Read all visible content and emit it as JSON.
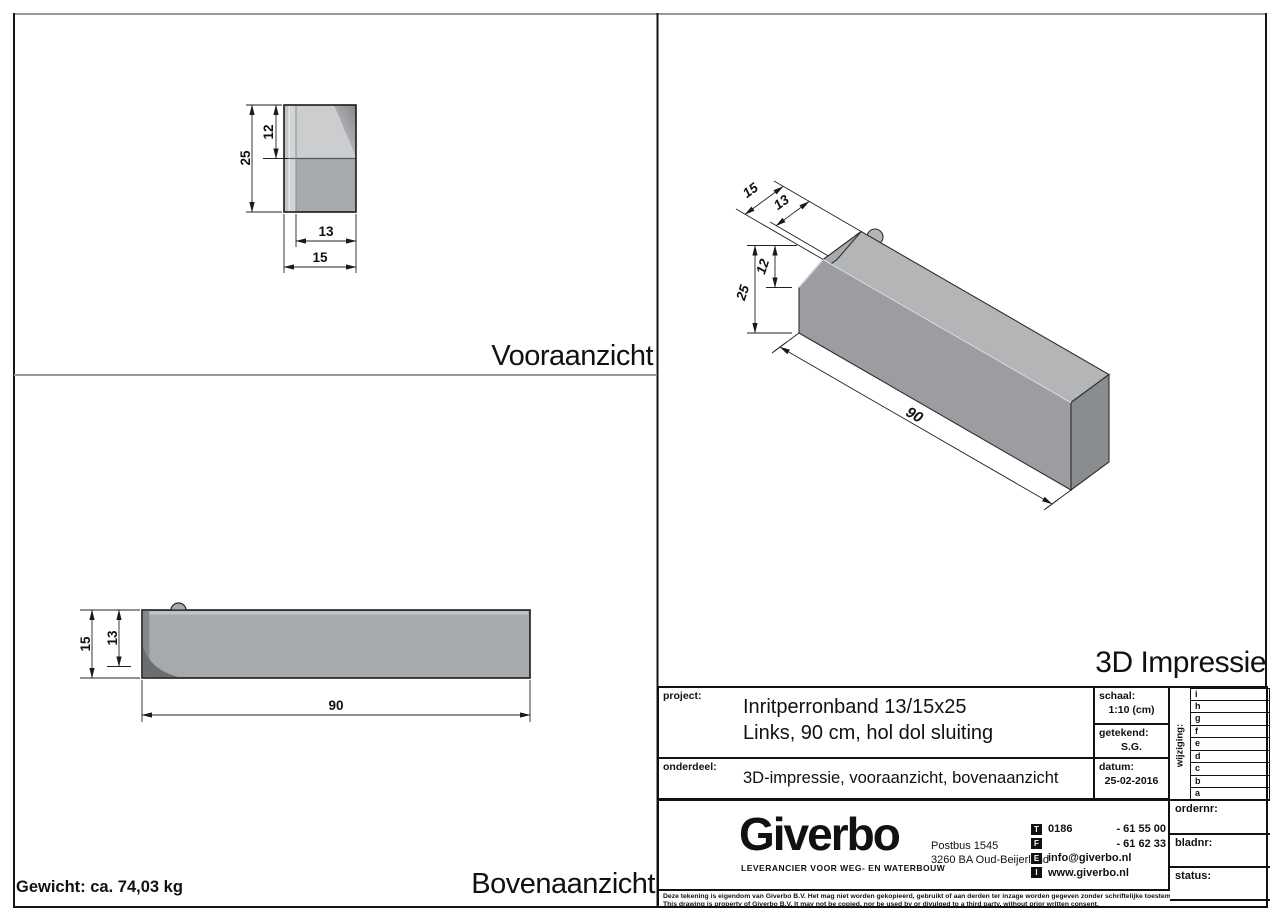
{
  "views": {
    "front": {
      "label": "Vooraanzicht",
      "dims": {
        "total_height": "25",
        "top_height": "12",
        "inner_width": "13",
        "total_width": "15"
      }
    },
    "top": {
      "label": "Bovenaanzicht",
      "weight": "Gewicht: ca. 74,03 kg",
      "dims": {
        "total_depth": "15",
        "inner_depth": "13",
        "length": "90"
      }
    },
    "iso": {
      "label": "3D Impressie",
      "dims": {
        "depth_outer": "15",
        "depth_inner": "13",
        "top_height": "12",
        "total_height": "25",
        "length": "90"
      }
    }
  },
  "title_block": {
    "project_label": "project:",
    "project_line1": "Inritperronband 13/15x25",
    "project_line2": "Links, 90 cm, hol dol sluiting",
    "onderdeel_label": "onderdeel:",
    "onderdeel_value": "3D-impressie, vooraanzicht, bovenaanzicht",
    "schaal_label": "schaal:",
    "schaal_value": "1:10 (cm)",
    "getekend_label": "getekend:",
    "getekend_value": "S.G.",
    "datum_label": "datum:",
    "datum_value": "25-02-2016",
    "wijziging_label": "wijziging:",
    "revisions": [
      "i",
      "h",
      "g",
      "f",
      "e",
      "d",
      "c",
      "b",
      "a"
    ],
    "ordernr_label": "ordernr:",
    "bladnr_label": "bladnr:",
    "status_label": "status:",
    "company": {
      "logo": "Giverbo",
      "tagline": "LEVERANCIER VOOR WEG- EN WATERBOUW",
      "address1": "Postbus 1545",
      "address2": "3260 BA Oud-Beijerland",
      "contacts": [
        {
          "icon": "T",
          "prefix": "0186",
          "value": "- 61 55 00"
        },
        {
          "icon": "F",
          "prefix": "",
          "value": "- 61 62 33"
        },
        {
          "icon": "E",
          "prefix": "",
          "value": "info@giverbo.nl"
        },
        {
          "icon": "I",
          "prefix": "",
          "value": "www.giverbo.nl"
        }
      ]
    },
    "disclaimer_nl": "Deze tekening is eigendom van Giverbo B.V. Het mag niet worden gekopieerd, gebruikt of aan derden ter inzage worden gegeven zonder schriftelijke toestemming vooraf.",
    "disclaimer_en": "This drawing is property of Giverbo B.V. It may not be copied, nor be used by or divulged to a third party, without prior written consent."
  },
  "colors": {
    "face_top": "#b3b5b7",
    "face_front": "#9b9da0",
    "face_end": "#8a8d8f",
    "face_slope": "#a8abad",
    "body_light": "#cbcdcf",
    "body_mid": "#a7aaac",
    "body_dark": "#85878a",
    "corner_dark": "#6b6d6f",
    "strip_outer": "#c3c5c7",
    "strip_inner": "#d3d5d7",
    "band_light": "#c2c4c6"
  }
}
